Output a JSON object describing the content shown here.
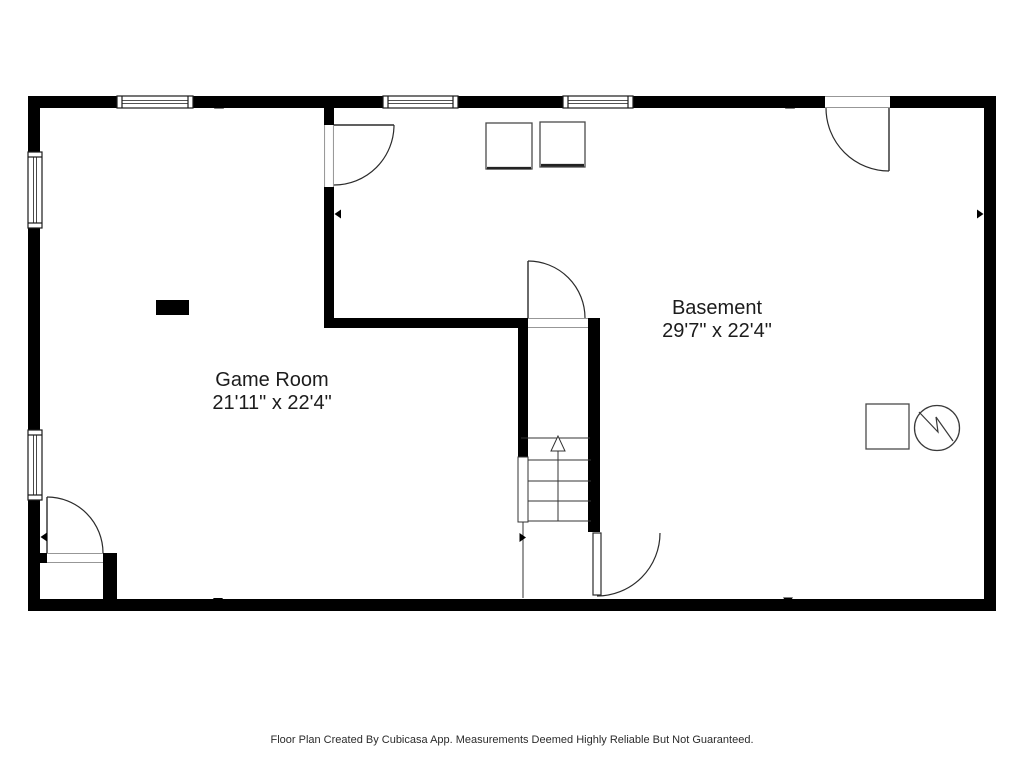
{
  "title": "Basement floor plan",
  "rooms": [
    {
      "name": "Game Room",
      "dimensions": "21'11\" x 22'4\""
    },
    {
      "name": "Basement",
      "dimensions": "29'7\" x 22'4\""
    }
  ],
  "footer": "Floor Plan Created By Cubicasa App. Measurements Deemed Highly Reliable But Not Guaranteed.",
  "colors": {
    "wall": "#000000",
    "line": "#2b2b2b",
    "fixture_line": "#4a4a4a",
    "background": "#ffffff",
    "text": "#1c1c1c"
  },
  "symbols": {
    "stairs": "staircase going up (arrow)",
    "water_heater": "circle with zigzag",
    "appliance_squares": 3,
    "doors": 5,
    "windows": 5,
    "measure_markers": 8
  }
}
